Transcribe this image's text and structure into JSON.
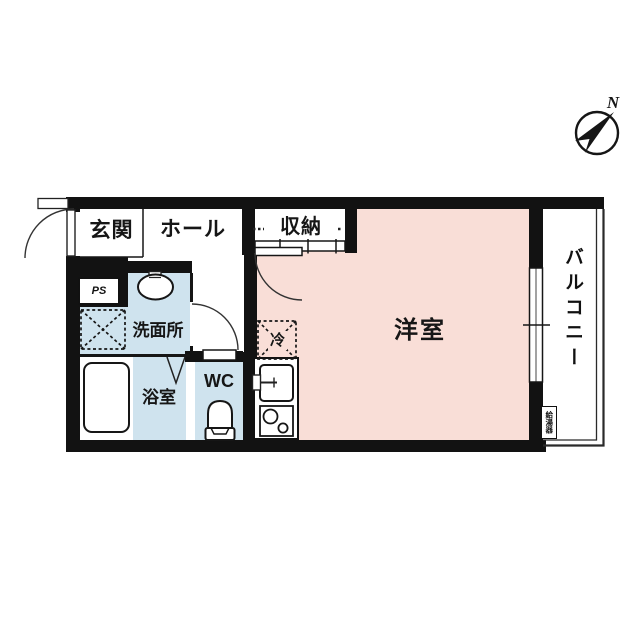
{
  "colors": {
    "room_floor": "#f9ded7",
    "wet_floor": "#cfe3ee",
    "wall": "#121212"
  },
  "compass": {
    "label": "N"
  },
  "rooms": {
    "genkan": {
      "label": "玄関"
    },
    "hall": {
      "label": "ホール"
    },
    "closet": {
      "label": "収納"
    },
    "western_room": {
      "label": "洋室"
    },
    "washroom": {
      "label": "洗面所"
    },
    "bathroom": {
      "label": "浴室"
    },
    "wc": {
      "label": "WC"
    },
    "balcony": {
      "label": "バルコニー"
    }
  },
  "annotations": {
    "pipe_space": {
      "label": "PS"
    },
    "refrigerator_space": {
      "label": "冷"
    },
    "water_heater": {
      "label": "給湯器"
    }
  }
}
